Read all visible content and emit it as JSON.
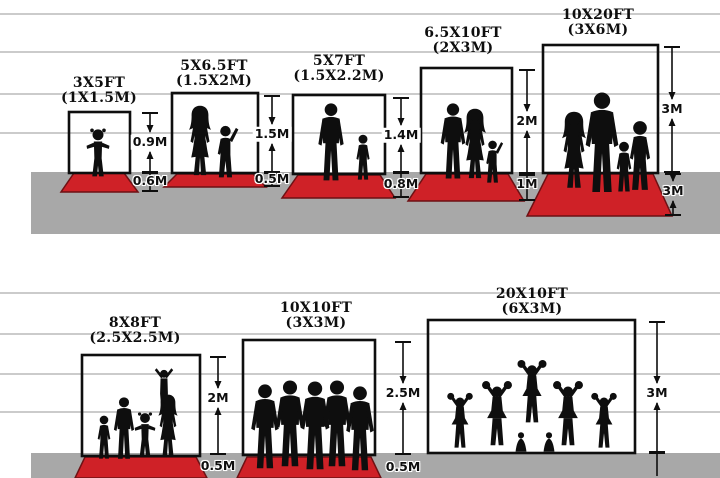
{
  "diagram_title": "Backdrop size comparison chart",
  "colors": {
    "carpet_red": "#cf2127",
    "carpet_edge": "#6e1114",
    "ground_gray": "#a8a8a8",
    "line_gray": "#cbcbcb",
    "ink": "#0e0e0e"
  },
  "background": {
    "lines_top": [
      14,
      52,
      94,
      133
    ],
    "lines_bottom": [
      293,
      334,
      374,
      412
    ],
    "ground_top": {
      "x": 31,
      "y": 172,
      "w": 689,
      "h": 62
    },
    "ground_bottom": {
      "x": 31,
      "y": 453,
      "w": 689,
      "h": 25
    }
  },
  "panels": [
    {
      "id": "3x5ft",
      "title_ft": "3X5FT",
      "title_m": "(1X1.5M)",
      "title_cx": 99,
      "title_top": 76,
      "frame": {
        "x": 69,
        "y": 112,
        "w": 61,
        "h": 61
      },
      "carpet": {
        "ty": 173,
        "by": 192,
        "tl": 74,
        "tr": 124,
        "bl": 61,
        "br": 138
      },
      "dims": [
        {
          "x": 150,
          "y1": 113,
          "y2": 172,
          "label": "0.9M",
          "ly": 142,
          "kind": "arrows",
          "bg": "white"
        },
        {
          "x": 150,
          "y1": 173,
          "y2": 191,
          "label": "0.6M",
          "ly": 181,
          "kind": "plain",
          "bg": "halo"
        }
      ],
      "figures": [
        {
          "type": "toddler",
          "cx": 98,
          "foot": 179,
          "h": 52
        }
      ],
      "figures_desc": "toddler girl with pigtails"
    },
    {
      "id": "5x6-5ft",
      "title_ft": "5X6.5FT",
      "title_m": "(1.5X2M)",
      "title_cx": 214,
      "title_top": 59,
      "frame": {
        "x": 172,
        "y": 93,
        "w": 86,
        "h": 80
      },
      "carpet": {
        "ty": 174,
        "by": 187,
        "tl": 177,
        "tr": 253,
        "bl": 164,
        "br": 266
      },
      "dims": [
        {
          "x": 272,
          "y1": 96,
          "y2": 172,
          "label": "1.5M",
          "ly": 134,
          "kind": "arrows",
          "bg": "white"
        },
        {
          "x": 272,
          "y1": 173,
          "y2": 186,
          "label": "0.5M",
          "ly": 179,
          "kind": "plain",
          "bg": "halo"
        }
      ],
      "figures": [
        {
          "type": "woman",
          "cx": 200,
          "foot": 178,
          "h": 73
        },
        {
          "type": "kid_armup",
          "cx": 226,
          "foot": 179,
          "h": 55
        }
      ],
      "figures_desc": "woman and child waving"
    },
    {
      "id": "5x7ft",
      "title_ft": "5X7FT",
      "title_m": "(1.5X2.2M)",
      "title_cx": 339,
      "title_top": 54,
      "frame": {
        "x": 293,
        "y": 95,
        "w": 92,
        "h": 79
      },
      "carpet": {
        "ty": 175,
        "by": 198,
        "tl": 298,
        "tr": 380,
        "bl": 282,
        "br": 395
      },
      "dims": [
        {
          "x": 401,
          "y1": 98,
          "y2": 172,
          "label": "1.4M",
          "ly": 135,
          "kind": "arrows",
          "bg": "white"
        },
        {
          "x": 401,
          "y1": 173,
          "y2": 197,
          "label": "0.8M",
          "ly": 184,
          "kind": "plain",
          "bg": "halo"
        }
      ],
      "figures": [
        {
          "type": "man",
          "cx": 331,
          "foot": 182,
          "h": 79
        },
        {
          "type": "boy",
          "cx": 363,
          "foot": 181,
          "h": 47
        }
      ],
      "figures_desc": "man and boy"
    },
    {
      "id": "6-5x10ft",
      "title_ft": "6.5X10FT",
      "title_m": "(2X3M)",
      "title_cx": 463,
      "title_top": 26,
      "frame": {
        "x": 421,
        "y": 68,
        "w": 91,
        "h": 105
      },
      "carpet": {
        "ty": 174,
        "by": 201,
        "tl": 426,
        "tr": 508,
        "bl": 408,
        "br": 524
      },
      "dims": [
        {
          "x": 527,
          "y1": 70,
          "y2": 173,
          "label": "2M",
          "ly": 121,
          "kind": "arrows",
          "bg": "white"
        },
        {
          "x": 527,
          "y1": 175,
          "y2": 200,
          "label": "1M",
          "ly": 184,
          "kind": "plain",
          "bg": "halo"
        }
      ],
      "figures": [
        {
          "type": "man",
          "cx": 453,
          "foot": 180,
          "h": 77
        },
        {
          "type": "woman",
          "cx": 475,
          "foot": 181,
          "h": 73
        },
        {
          "type": "kid_armup",
          "cx": 493,
          "foot": 184,
          "h": 45
        }
      ],
      "figures_desc": "man, woman and small child"
    },
    {
      "id": "10x20ft",
      "title_ft": "10X20FT",
      "title_m": "(3X6M)",
      "title_cx": 598,
      "title_top": 8,
      "frame": {
        "x": 543,
        "y": 45,
        "w": 115,
        "h": 128
      },
      "carpet": {
        "ty": 174,
        "by": 216,
        "tl": 548,
        "tr": 653,
        "bl": 527,
        "br": 672
      },
      "dims": [
        {
          "x": 672,
          "y1": 47,
          "y2": 172,
          "label": "3M",
          "ly": 109,
          "kind": "arrows",
          "bg": "white"
        },
        {
          "x": 673,
          "y1": 174,
          "y2": 215,
          "label": "3M",
          "ly": 191,
          "kind": "arrows",
          "bg": "halo"
        }
      ],
      "figures": [
        {
          "type": "woman",
          "cx": 574,
          "foot": 191,
          "h": 80
        },
        {
          "type": "man",
          "cx": 602,
          "foot": 194,
          "h": 102
        },
        {
          "type": "boy",
          "cx": 624,
          "foot": 193,
          "h": 52
        },
        {
          "type": "boy",
          "cx": 640,
          "foot": 192,
          "h": 72
        }
      ],
      "figures_desc": "family of four"
    },
    {
      "id": "8x8ft",
      "title_ft": "8X8FT",
      "title_m": "(2.5X2.5M)",
      "title_cx": 135,
      "title_top": 316,
      "frame": {
        "x": 82,
        "y": 355,
        "w": 118,
        "h": 101
      },
      "carpet": {
        "ty": 457,
        "by": 478,
        "tl": 85,
        "tr": 196,
        "bl": 75,
        "br": 207
      },
      "dims": [
        {
          "x": 218,
          "y1": 357,
          "y2": 454,
          "label": "2M",
          "ly": 398,
          "kind": "arrows",
          "bg": "white"
        },
        {
          "x": 218,
          "y1": 0,
          "y2": 0,
          "label": "0.5M",
          "ly": 466,
          "kind": "labelonly",
          "bg": "halo"
        }
      ],
      "figures": [
        {
          "type": "boy",
          "cx": 104,
          "foot": 460,
          "h": 45
        },
        {
          "type": "man",
          "cx": 124,
          "foot": 460,
          "h": 63
        },
        {
          "type": "toddler",
          "cx": 145,
          "foot": 458,
          "h": 47
        },
        {
          "type": "woman",
          "cx": 168,
          "foot": 458,
          "h": 64
        },
        {
          "type": "armsV",
          "cx": 164,
          "foot": 412,
          "h": 46
        }
      ],
      "figures_desc": "family with child raised on shoulders"
    },
    {
      "id": "10x10ft",
      "title_ft": "10X10FT",
      "title_m": "(3X3M)",
      "title_cx": 316,
      "title_top": 301,
      "frame": {
        "x": 243,
        "y": 340,
        "w": 132,
        "h": 115
      },
      "carpet": {
        "ty": 457,
        "by": 478,
        "tl": 247,
        "tr": 371,
        "bl": 237,
        "br": 381
      },
      "dims": [
        {
          "x": 403,
          "y1": 342,
          "y2": 454,
          "label": "2.5M",
          "ly": 393,
          "kind": "arrows",
          "bg": "white"
        },
        {
          "x": 403,
          "y1": 0,
          "y2": 0,
          "label": "0.5M",
          "ly": 467,
          "kind": "labelonly",
          "bg": "halo"
        }
      ],
      "figures": [
        {
          "type": "man",
          "cx": 265,
          "foot": 470,
          "h": 86
        },
        {
          "type": "man",
          "cx": 290,
          "foot": 468,
          "h": 88
        },
        {
          "type": "man",
          "cx": 315,
          "foot": 471,
          "h": 90
        },
        {
          "type": "man",
          "cx": 337,
          "foot": 468,
          "h": 88
        },
        {
          "type": "man",
          "cx": 360,
          "foot": 472,
          "h": 86
        }
      ],
      "figures_desc": "group of five men"
    },
    {
      "id": "20x10ft",
      "title_ft": "20X10FT",
      "title_m": "(6X3M)",
      "title_cx": 532,
      "title_top": 287,
      "frame": {
        "x": 428,
        "y": 320,
        "w": 207,
        "h": 133
      },
      "carpet": null,
      "dims": [
        {
          "x": 657,
          "y1": 322,
          "y2": 452,
          "label": "3M",
          "ly": 393,
          "kind": "arrows",
          "bg": "white"
        },
        {
          "x": 657,
          "y1": 453,
          "y2": 476,
          "label": "",
          "ly": 0,
          "kind": "stub",
          "bg": "halo"
        }
      ],
      "figures": [
        {
          "type": "cheer",
          "cx": 460,
          "foot": 450,
          "h": 58
        },
        {
          "type": "cheer",
          "cx": 497,
          "foot": 448,
          "h": 68
        },
        {
          "type": "crouch",
          "cx": 521,
          "foot": 453,
          "h": 34
        },
        {
          "type": "crouch",
          "cx": 549,
          "foot": 453,
          "h": 34
        },
        {
          "type": "cheer",
          "cx": 532,
          "foot": 425,
          "h": 66
        },
        {
          "type": "cheer",
          "cx": 568,
          "foot": 448,
          "h": 68
        },
        {
          "type": "cheer",
          "cx": 604,
          "foot": 450,
          "h": 58
        }
      ],
      "figures_desc": "cheerleading squad with pyramid"
    }
  ]
}
